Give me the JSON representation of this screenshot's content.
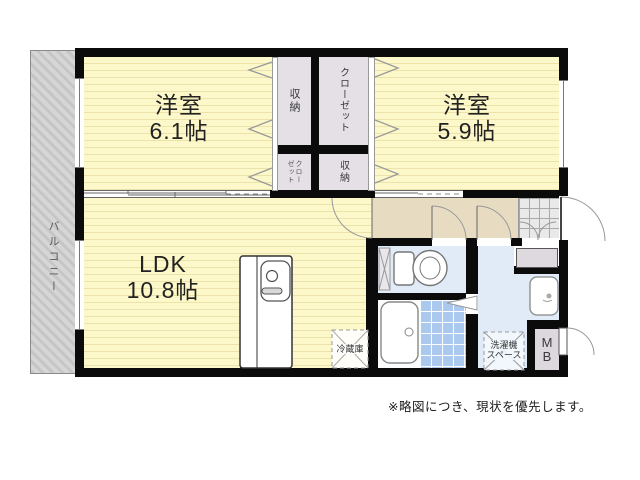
{
  "plan": {
    "note": "※略図につき、現状を優先します。",
    "balcony": {
      "label": "バルコニー"
    },
    "rooms": {
      "bedroom1": {
        "name": "洋室",
        "size": "6.1帖"
      },
      "bedroom2": {
        "name": "洋室",
        "size": "5.9帖"
      },
      "ldk": {
        "name": "LDK",
        "size": "10.8帖"
      }
    },
    "storage": {
      "b1_top": "収納",
      "b1_bottom": "クローゼット",
      "b2_top": "クローゼット",
      "b2_bottom": "収納"
    },
    "fixtures": {
      "refrigerator": "冷蔵庫",
      "washer_line1": "洗濯機",
      "washer_line2": "スペース",
      "meter_box_line1": "M",
      "meter_box_line2": "B"
    },
    "colors": {
      "wall": "#0b0b0b",
      "room_yellow": "#fcf8c9",
      "room_stripe": "#ebe3ab",
      "hall_beige": "#e7dcc1",
      "storage_gray": "#e4e0e6",
      "wet_area_blue": "#e0ebf7",
      "bath_tile_blue": "#abc8ee",
      "balcony_gray": "#d2d2d2"
    }
  }
}
